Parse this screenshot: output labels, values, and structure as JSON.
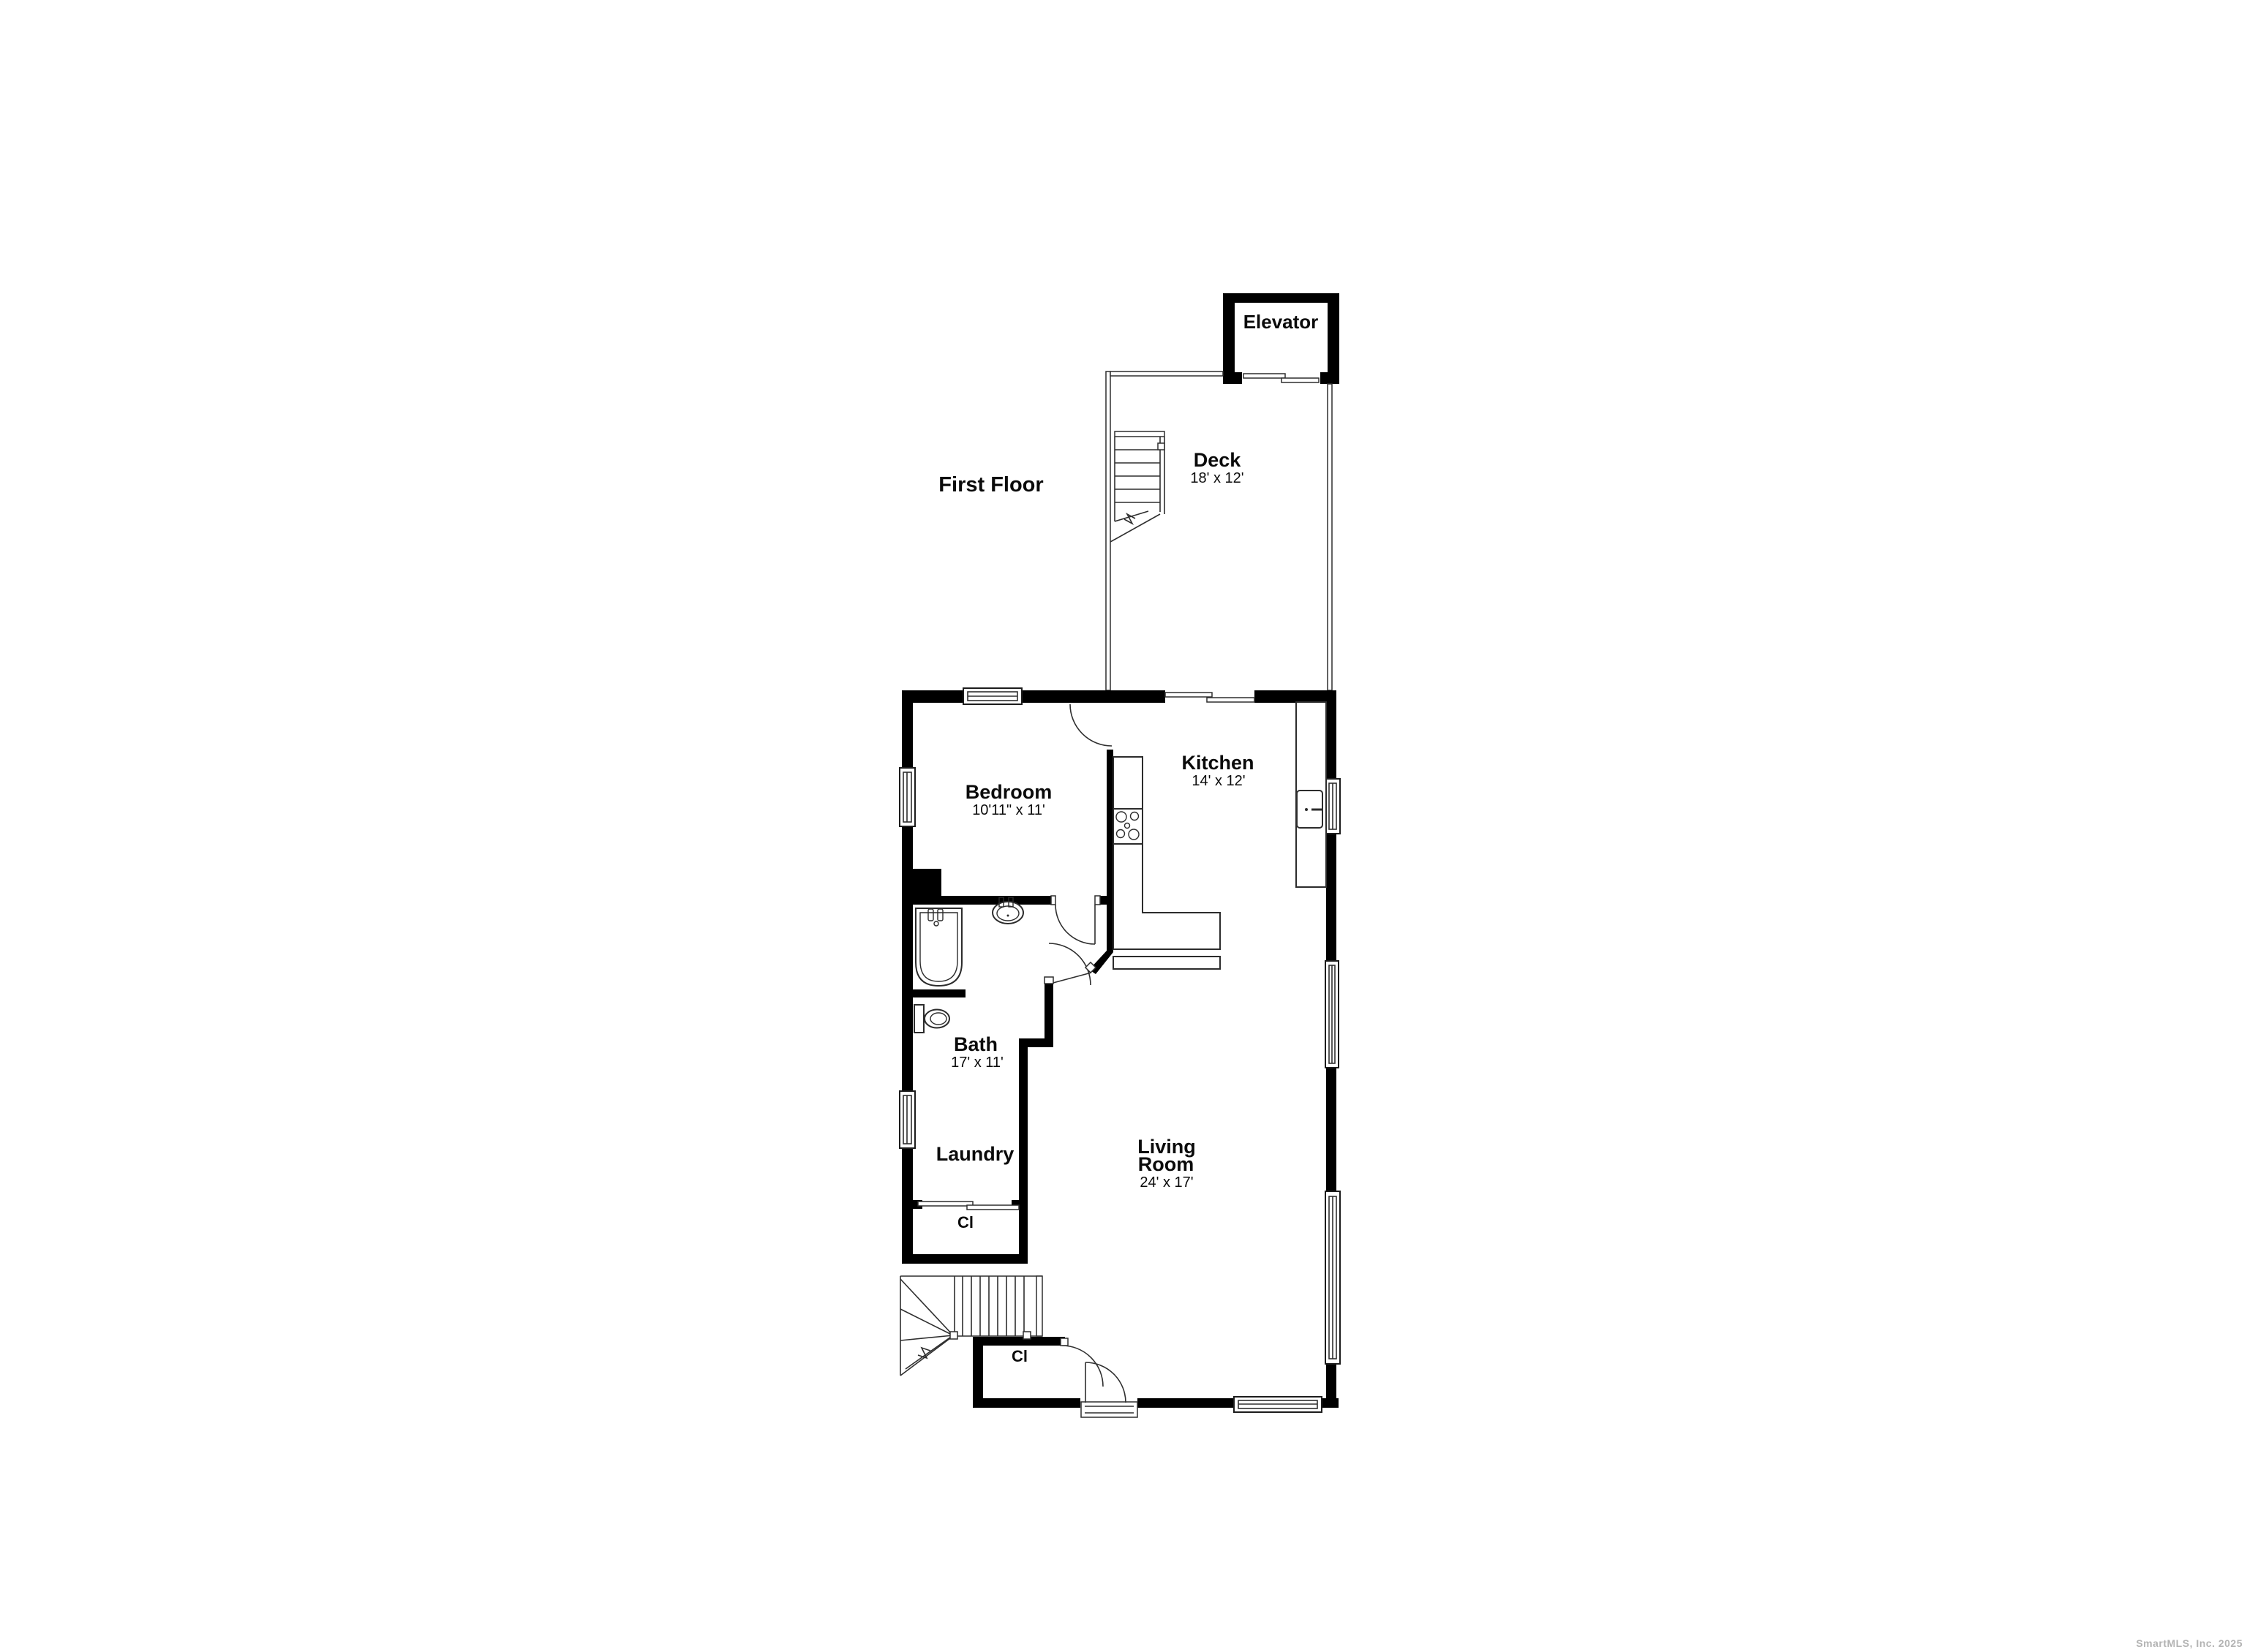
{
  "title": "First Floor",
  "watermark": "SmartMLS, Inc. 2025",
  "colors": {
    "wall": "#000000",
    "line": "#2f2f2f",
    "background": "#ffffff",
    "watermark": "#b3b3b3"
  },
  "rooms": {
    "elevator": {
      "name": "Elevator"
    },
    "deck": {
      "name": "Deck",
      "dims": "18' x 12'"
    },
    "bedroom": {
      "name": "Bedroom",
      "dims": "10'11\" x 11'"
    },
    "kitchen": {
      "name": "Kitchen",
      "dims": "14' x 12'"
    },
    "bath": {
      "name": "Bath",
      "dims": "17' x 11'"
    },
    "laundry": {
      "name": "Laundry"
    },
    "closet1": {
      "name": "Cl"
    },
    "closet2": {
      "name": "Cl"
    },
    "living": {
      "name_line1": "Living",
      "name_line2": "Room",
      "dims": "24' x 17'"
    }
  }
}
